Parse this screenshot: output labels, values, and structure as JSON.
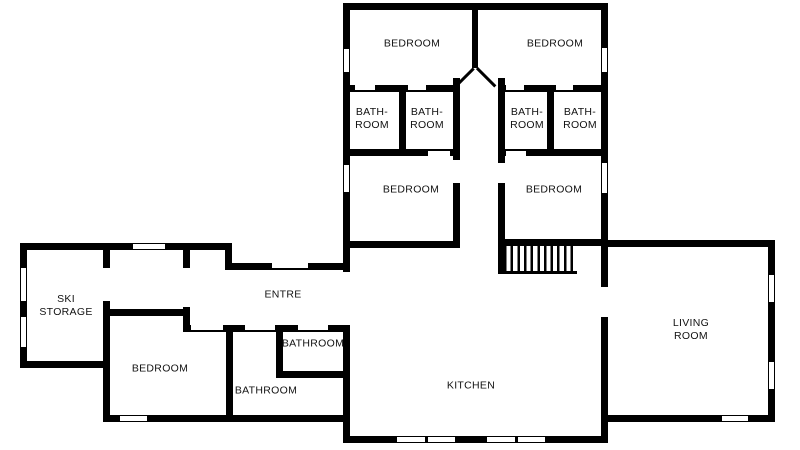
{
  "colors": {
    "wall": "#000000",
    "background": "#ffffff",
    "label_text": "#111111"
  },
  "rooms": [
    {
      "id": "bedroom-top-left",
      "lines": [
        "BEDROOM"
      ]
    },
    {
      "id": "bedroom-top-right",
      "lines": [
        "BEDROOM"
      ]
    },
    {
      "id": "bathroom-1",
      "lines": [
        "BATH-",
        "ROOM"
      ]
    },
    {
      "id": "bathroom-2",
      "lines": [
        "BATH-",
        "ROOM"
      ]
    },
    {
      "id": "bathroom-3",
      "lines": [
        "BATH-",
        "ROOM"
      ]
    },
    {
      "id": "bathroom-4",
      "lines": [
        "BATH-",
        "ROOM"
      ]
    },
    {
      "id": "bedroom-mid-left",
      "lines": [
        "BEDROOM"
      ]
    },
    {
      "id": "bedroom-mid-right",
      "lines": [
        "BEDROOM"
      ]
    },
    {
      "id": "ski-storage",
      "lines": [
        "SKI",
        "STORAGE"
      ]
    },
    {
      "id": "bedroom-west",
      "lines": [
        "BEDROOM"
      ]
    },
    {
      "id": "bathroom-small",
      "lines": [
        "BATHROOM"
      ]
    },
    {
      "id": "bathroom-large",
      "lines": [
        "BATHROOM"
      ]
    },
    {
      "id": "entre",
      "lines": [
        "ENTRE"
      ]
    },
    {
      "id": "kitchen",
      "lines": [
        "KITCHEN"
      ]
    },
    {
      "id": "living-room",
      "lines": [
        "LIVING",
        "ROOM"
      ]
    }
  ]
}
